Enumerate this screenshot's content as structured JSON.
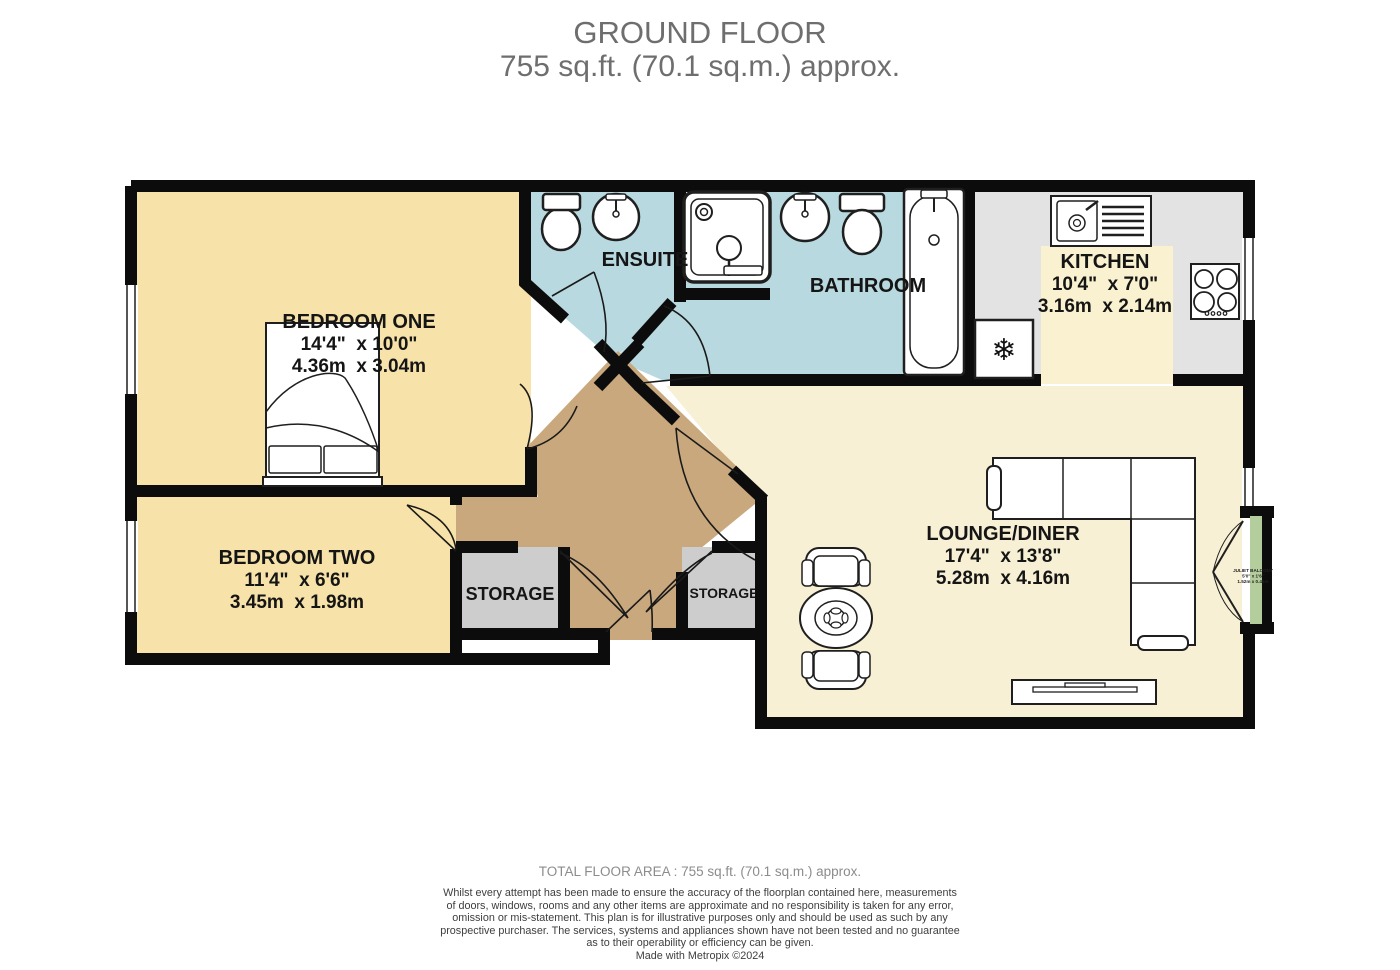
{
  "title": {
    "floor": "GROUND FLOOR",
    "area": "755 sq.ft. (70.1 sq.m.) approx."
  },
  "rooms": {
    "bedroom_one": {
      "name": "BEDROOM ONE",
      "imperial": "14'4\"  x 10'0\"",
      "metric": "4.36m  x 3.04m"
    },
    "bedroom_two": {
      "name": "BEDROOM TWO",
      "imperial": "11'4\"  x 6'6\"",
      "metric": "3.45m  x 1.98m"
    },
    "ensuite": {
      "name": "ENSUITE"
    },
    "bathroom": {
      "name": "BATHROOM"
    },
    "kitchen": {
      "name": "KITCHEN",
      "imperial": "10'4\"  x 7'0\"",
      "metric": "3.16m  x 2.14m"
    },
    "lounge_diner": {
      "name": "LOUNGE/DINER",
      "imperial": "17'4\"  x 13'8\"",
      "metric": "5.28m  x 4.16m"
    },
    "storage_left": {
      "name": "STORAGE"
    },
    "storage_right": {
      "name": "STORAGE"
    },
    "juliet_balcony": {
      "name": "JULIET BALCONY",
      "imperial": "5'0\" x 1'6\"",
      "metric": "1.52m x 0.46m"
    }
  },
  "footer": {
    "total_area": "TOTAL FLOOR AREA : 755 sq.ft. (70.1 sq.m.) approx.",
    "disclaimer_lines": [
      "Whilst every attempt has been made to ensure the accuracy of the floorplan contained here, measurements",
      "of doors, windows, rooms and any other items are approximate and no responsibility is taken for any error,",
      "omission or mis-statement. This plan is for illustrative purposes only and should be used as such by any",
      "prospective purchaser. The services, systems and appliances shown have not been tested and no guarantee",
      "as to their operability or efficiency can be given."
    ],
    "credit": "Made with Metropix ©2024"
  },
  "colors": {
    "bedroom": "#F7E3A9",
    "lounge": "#F8F0D4",
    "wet_room": "#B8D9DF",
    "hallway": "#C9A87E",
    "kitchen_floor": "#E3E3E3",
    "kitchen_worktop": "#F9F1CF",
    "storage": "#CDCDCD",
    "balcony": "#B3CD9C",
    "wall": "#0C0C0C"
  }
}
